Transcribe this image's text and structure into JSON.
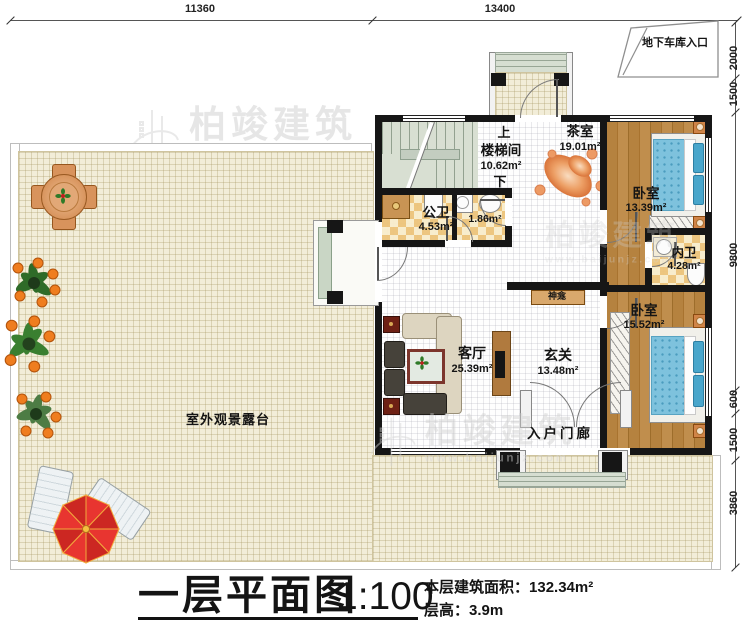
{
  "dimensions": {
    "top": [
      "11360",
      "13400"
    ],
    "right": [
      "2000",
      "1500",
      "9800",
      "600",
      "1500",
      "3860"
    ]
  },
  "garage": {
    "label": "地下车库入口"
  },
  "rooms": {
    "stair": {
      "up": "上",
      "name": "楼梯间",
      "area": "10.62m²",
      "down": "下"
    },
    "tea": {
      "name": "茶室",
      "area": "19.01m²"
    },
    "bedroom1": {
      "name": "卧室",
      "area": "13.39m²"
    },
    "inner_bath": {
      "name": "内卫",
      "area": "4.28m²"
    },
    "bedroom2": {
      "name": "卧室",
      "area": "15.52m²"
    },
    "public_bath": {
      "name": "公卫",
      "area": "4.53m²"
    },
    "utility": {
      "area": "1.86m²"
    },
    "living": {
      "name": "客厅",
      "area": "25.39m²"
    },
    "foyer": {
      "name": "玄关",
      "area": "13.48m²"
    },
    "shrine": {
      "name": "神龛"
    },
    "entry_porch": {
      "name": "入户门廊"
    },
    "terrace": {
      "name": "室外观景露台"
    }
  },
  "title_block": {
    "title": "一层平面图",
    "scale": "1:100",
    "area_label": "本层建筑面积：",
    "area_value": "132.34m²",
    "floor_height": "层高：3.9m"
  },
  "watermark": {
    "brand": "柏竣建筑",
    "url": "www.baijunjz.com"
  },
  "colors": {
    "wall": "#161616",
    "terrace_floor": "#f2edd8",
    "wood_floor": "#b5823f",
    "bath_tile": "#ecc379",
    "stair_floor": "#d8dfd2",
    "bed_blue": "#7ec2dd",
    "umbrella_red": "#e83530",
    "shrine_wood": "#d9a86c",
    "watermark_gray": "#cfcfcf"
  }
}
